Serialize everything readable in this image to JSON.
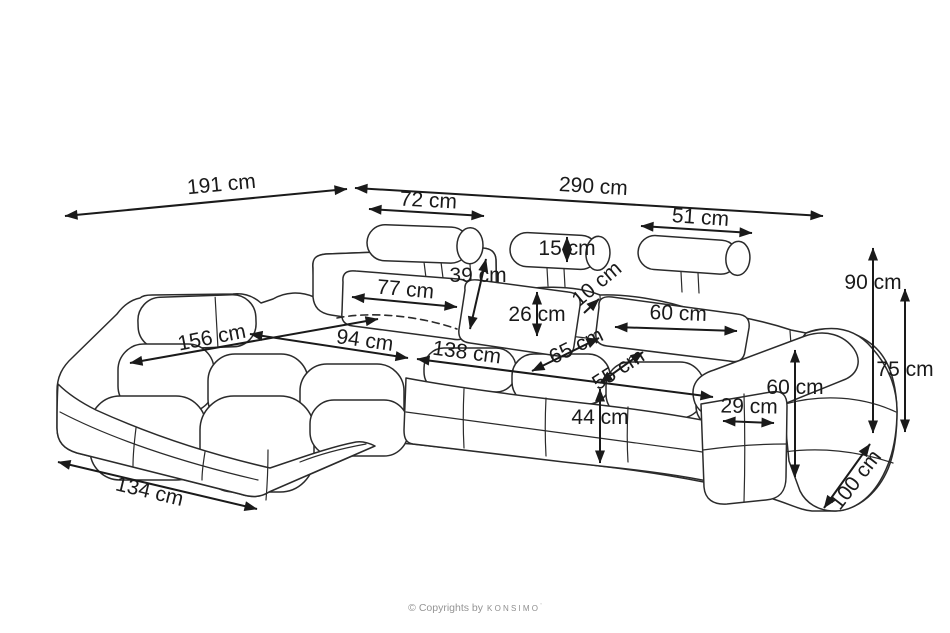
{
  "diagram": {
    "unit": "cm",
    "line_color": "#2b2b2b",
    "label_color": "#1a1a1a",
    "background": "#ffffff"
  },
  "dimensions": [
    {
      "name": "chaise-side-total-length",
      "label": "191 cm"
    },
    {
      "name": "total-width",
      "label": "290 cm"
    },
    {
      "name": "left-headrest-width",
      "label": "72 cm"
    },
    {
      "name": "right-headrest-width",
      "label": "51 cm"
    },
    {
      "name": "headrest-roll-height",
      "label": "15 cm"
    },
    {
      "name": "backrest-height",
      "label": "39 cm"
    },
    {
      "name": "left-back-cushion-width",
      "label": "77 cm"
    },
    {
      "name": "back-cushion-height",
      "label": "26 cm"
    },
    {
      "name": "headrest-adjustment-range",
      "label": "10 cm"
    },
    {
      "name": "right-back-cushion-width",
      "label": "60 cm"
    },
    {
      "name": "chaise-sleeping-length",
      "label": "156 cm"
    },
    {
      "name": "chaise-seat-width",
      "label": "94 cm"
    },
    {
      "name": "seat-width",
      "label": "138 cm"
    },
    {
      "name": "seat-depth-back",
      "label": "65 cm"
    },
    {
      "name": "seat-depth-front",
      "label": "55 cm"
    },
    {
      "name": "seat-height",
      "label": "44 cm"
    },
    {
      "name": "armrest-height",
      "label": "60 cm"
    },
    {
      "name": "armrest-width",
      "label": "29 cm"
    },
    {
      "name": "total-height",
      "label": "90 cm"
    },
    {
      "name": "backrest-top-height",
      "label": "75 cm"
    },
    {
      "name": "total-depth",
      "label": "100 cm"
    },
    {
      "name": "chaise-front-width",
      "label": "134 cm"
    }
  ],
  "footer": {
    "copyright_prefix": "© Copyrights by",
    "brand": "konsimo"
  }
}
